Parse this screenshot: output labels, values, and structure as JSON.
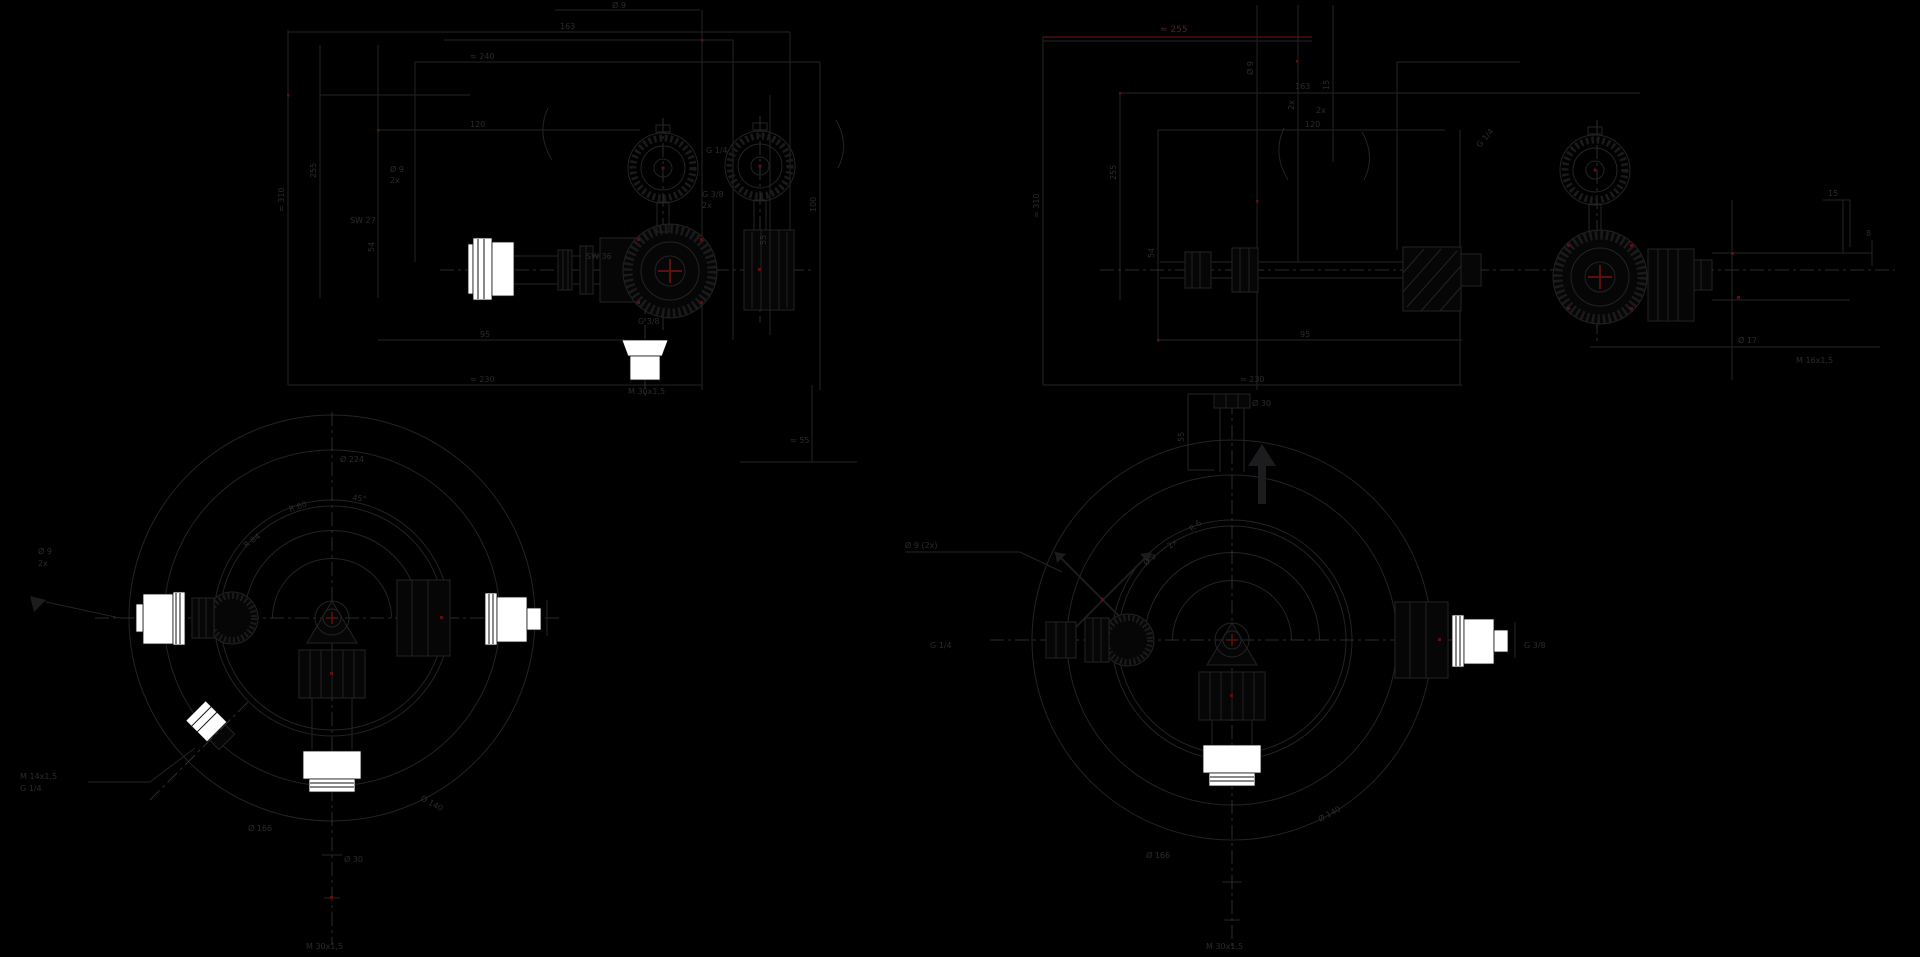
{
  "colors": {
    "background": "#000000",
    "line": "#232325",
    "centerline": "#39393b",
    "fitting_white": "#ffffff",
    "accent_red": "#5a1010",
    "dim_red_line": "#4a0e0e",
    "text": "#2b2b2d"
  },
  "views": {
    "front_left": {
      "labels": {
        "top_holes": "Ø 9",
        "top_width": "163",
        "overall_width": "≈ 240",
        "height_overall": "≈ 310",
        "height_body": "255",
        "offset": "54",
        "depth": "120",
        "base_width": "95",
        "overall_bottom": "≈ 230",
        "side_height": "100",
        "side_offset": "55",
        "hole_note": "Ø 9",
        "hole_count": "2x",
        "wrench_inlet": "SW 27",
        "wrench_body": "SW 36",
        "inlet_thread": "G 1/4",
        "outlet_thread": "G 3/8",
        "outlet_count": "2x",
        "bottom_thread": "G 3/8",
        "bottom_conn": "M 30x1,5",
        "bracket_dim": "≈ 55"
      }
    },
    "side_right": {
      "labels": {
        "red_dim": "≈ 255",
        "top_width": "163",
        "depth": "120",
        "height_overall": "≈ 310",
        "height_body": "255",
        "offset": "54",
        "holes": "Ø 9",
        "holes_count": "2x",
        "edge": "15",
        "base_width": "95",
        "overall_bottom": "≈ 230",
        "gauge_ports": "2x",
        "port_thread": "G 1/4",
        "right_edge": "15",
        "right_small": "8",
        "outlet_dia": "Ø 17",
        "outlet_conn": "M 16x1,5"
      }
    },
    "plan_left": {
      "labels": {
        "holes": "Ø 9",
        "holes_count": "2x",
        "ring_a": "R 84",
        "ring_b": "R 60",
        "angle": "45°",
        "outer_dia": "Ø 224",
        "side_conn": "M 14x1,5",
        "side_thread": "G 1/4",
        "bottom_dia": "Ø 166",
        "flange_dia": "Ø 140",
        "stub_dia": "Ø 30",
        "bottom_conn": "M 30x1,5"
      }
    },
    "plan_right": {
      "labels": {
        "leader": "Ø 9 (2x)",
        "stub_height": "55",
        "stub_dia": "Ø 30",
        "knurl_a": "Ø 9",
        "knurl_b": "2x",
        "knurl_c": "R 6",
        "left_thread": "G 1/4",
        "right_thread": "G 3/8",
        "bottom_dia": "Ø 166",
        "flange_dia": "Ø 140",
        "bottom_conn": "M 30x1,5"
      }
    }
  }
}
